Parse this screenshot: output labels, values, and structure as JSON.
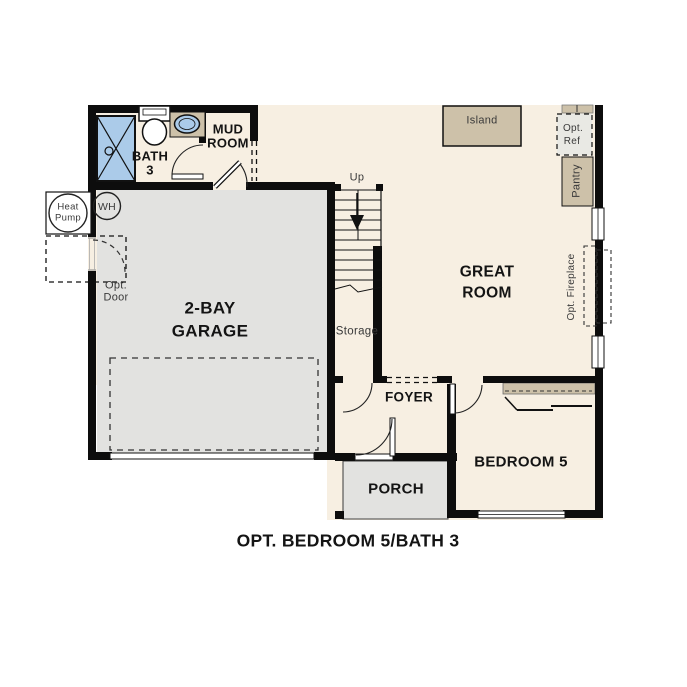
{
  "plan": {
    "caption": "OPT. BEDROOM 5/BATH 3",
    "rooms": {
      "bath3": {
        "line1": "BATH",
        "line2": "3"
      },
      "mudroom": {
        "line1": "MUD",
        "line2": "ROOM"
      },
      "garage": {
        "line1": "2-BAY",
        "line2": "GARAGE"
      },
      "great_room": {
        "line1": "GREAT",
        "line2": "ROOM"
      },
      "foyer": {
        "label": "FOYER"
      },
      "porch": {
        "label": "PORCH"
      },
      "bedroom5": {
        "label": "BEDROOM 5"
      },
      "storage": {
        "label": "Storage"
      }
    },
    "features": {
      "island": "Island",
      "pantry": "Pantry",
      "opt_ref": {
        "line1": "Opt.",
        "line2": "Ref"
      },
      "opt_fireplace": "Opt. Fireplace",
      "opt_door": {
        "line1": "Opt.",
        "line2": "Door"
      },
      "heat_pump": {
        "line1": "Heat",
        "line2": "Pump"
      },
      "water_heater": "WH",
      "stairs_direction": "Up"
    },
    "colors": {
      "floor_cream": "#f7efe2",
      "floor_gray": "#e2e2e0",
      "cabinet_tan": "#cdc1a9",
      "fixture_blue": "#abcbe9",
      "wall_black": "#0d0d0d",
      "opt_ref_gray": "#e9e9e4",
      "background": "#ffffff"
    }
  }
}
